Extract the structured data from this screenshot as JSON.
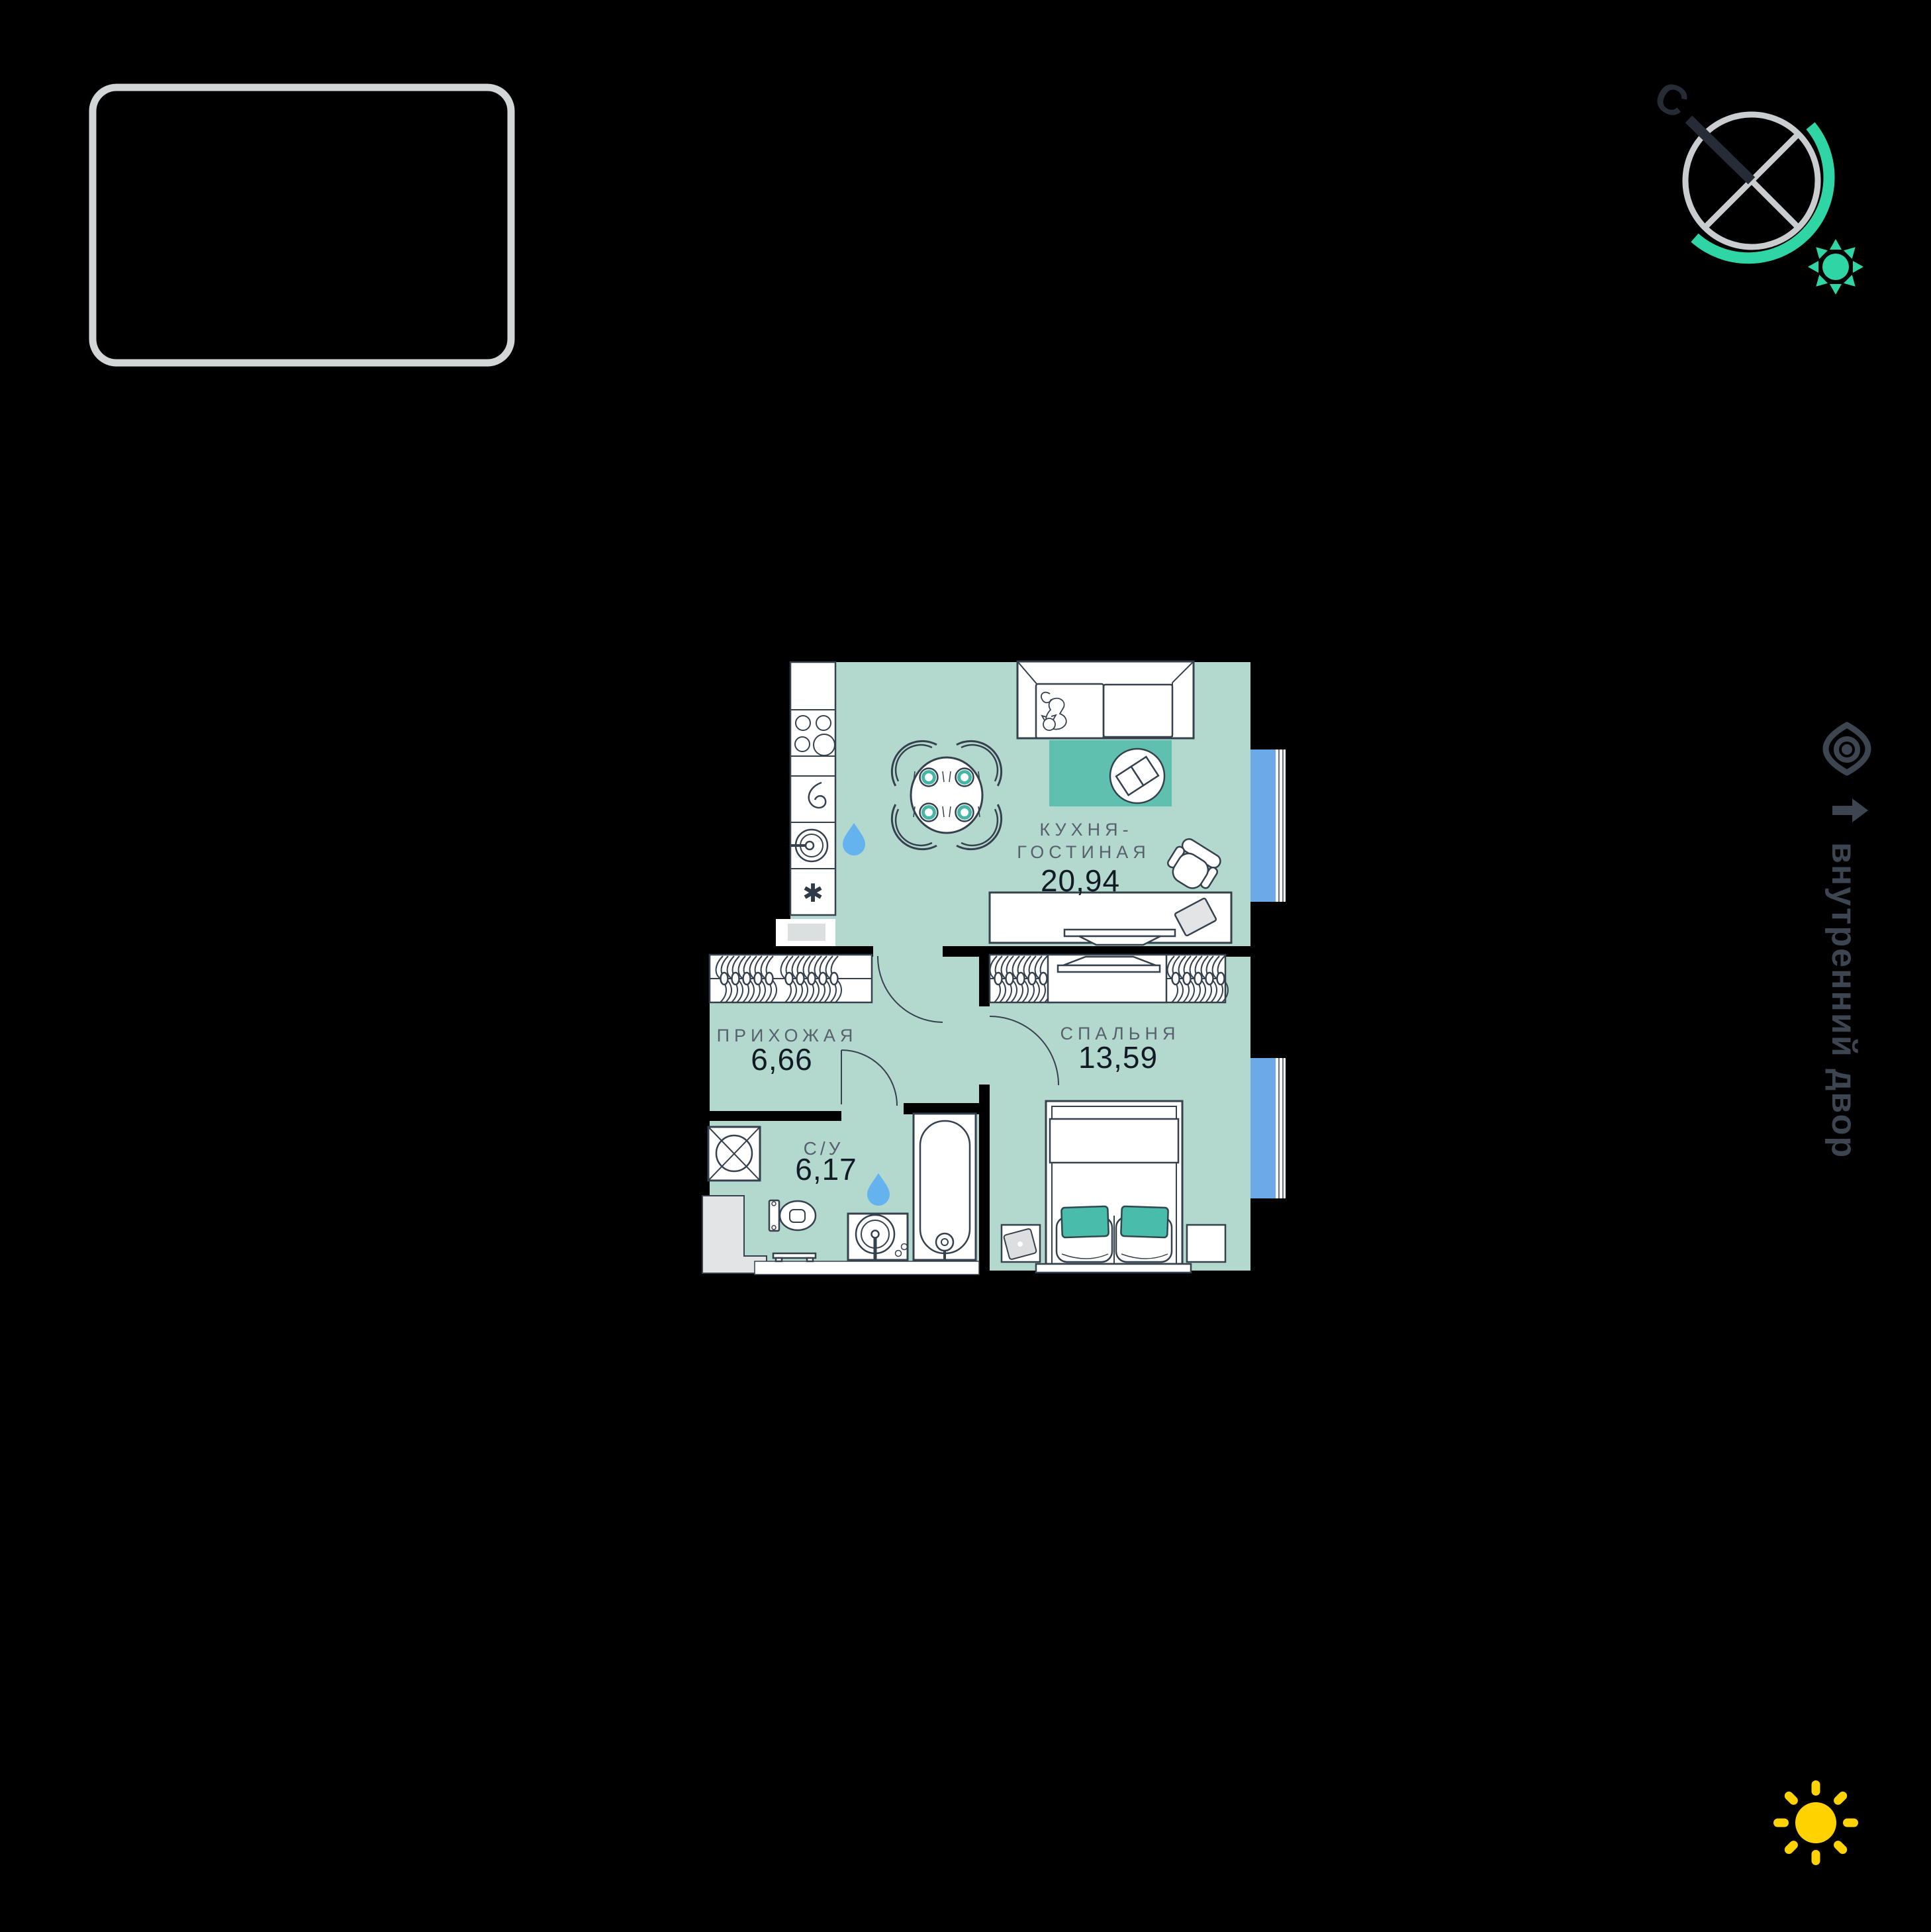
{
  "plan": {
    "rooms": [
      {
        "id": "kitchen-living",
        "name_lines": [
          "КУХНЯ-",
          "ГОСТИНАЯ"
        ],
        "area": "20,94"
      },
      {
        "id": "hallway",
        "name_lines": [
          "ПРИХОЖАЯ"
        ],
        "area": "6,66"
      },
      {
        "id": "bedroom",
        "name_lines": [
          "СПАЛЬНЯ"
        ],
        "area": "13,59"
      },
      {
        "id": "bathroom",
        "name_lines": [
          "С/У"
        ],
        "area": "6,17"
      }
    ],
    "symbols": {
      "freezer_asterisk": "✱"
    }
  },
  "compass": {
    "north_label": "С"
  },
  "annotations": {
    "courtyard_label": "внутренний двор"
  },
  "colors": {
    "background": "#000000",
    "floor": "#b3d8cd",
    "rug_teal": "#5fc0af",
    "pillow_teal": "#49bcab",
    "plate_ring_teal": "#45b5a5",
    "window_blue": "#6ca9e9",
    "water_drop_blue": "#64b3ee",
    "outline_dark": "#36414e",
    "legend_border_gray": "#d2d6d7",
    "compass_gray": "#c9cdcf",
    "compass_teal": "#2fd5a5",
    "needle_dark": "#262c35",
    "annotation_slate": "#3d4550",
    "sun_yellow": "#ffd200",
    "shaft_gray": "#e2e4e5"
  }
}
